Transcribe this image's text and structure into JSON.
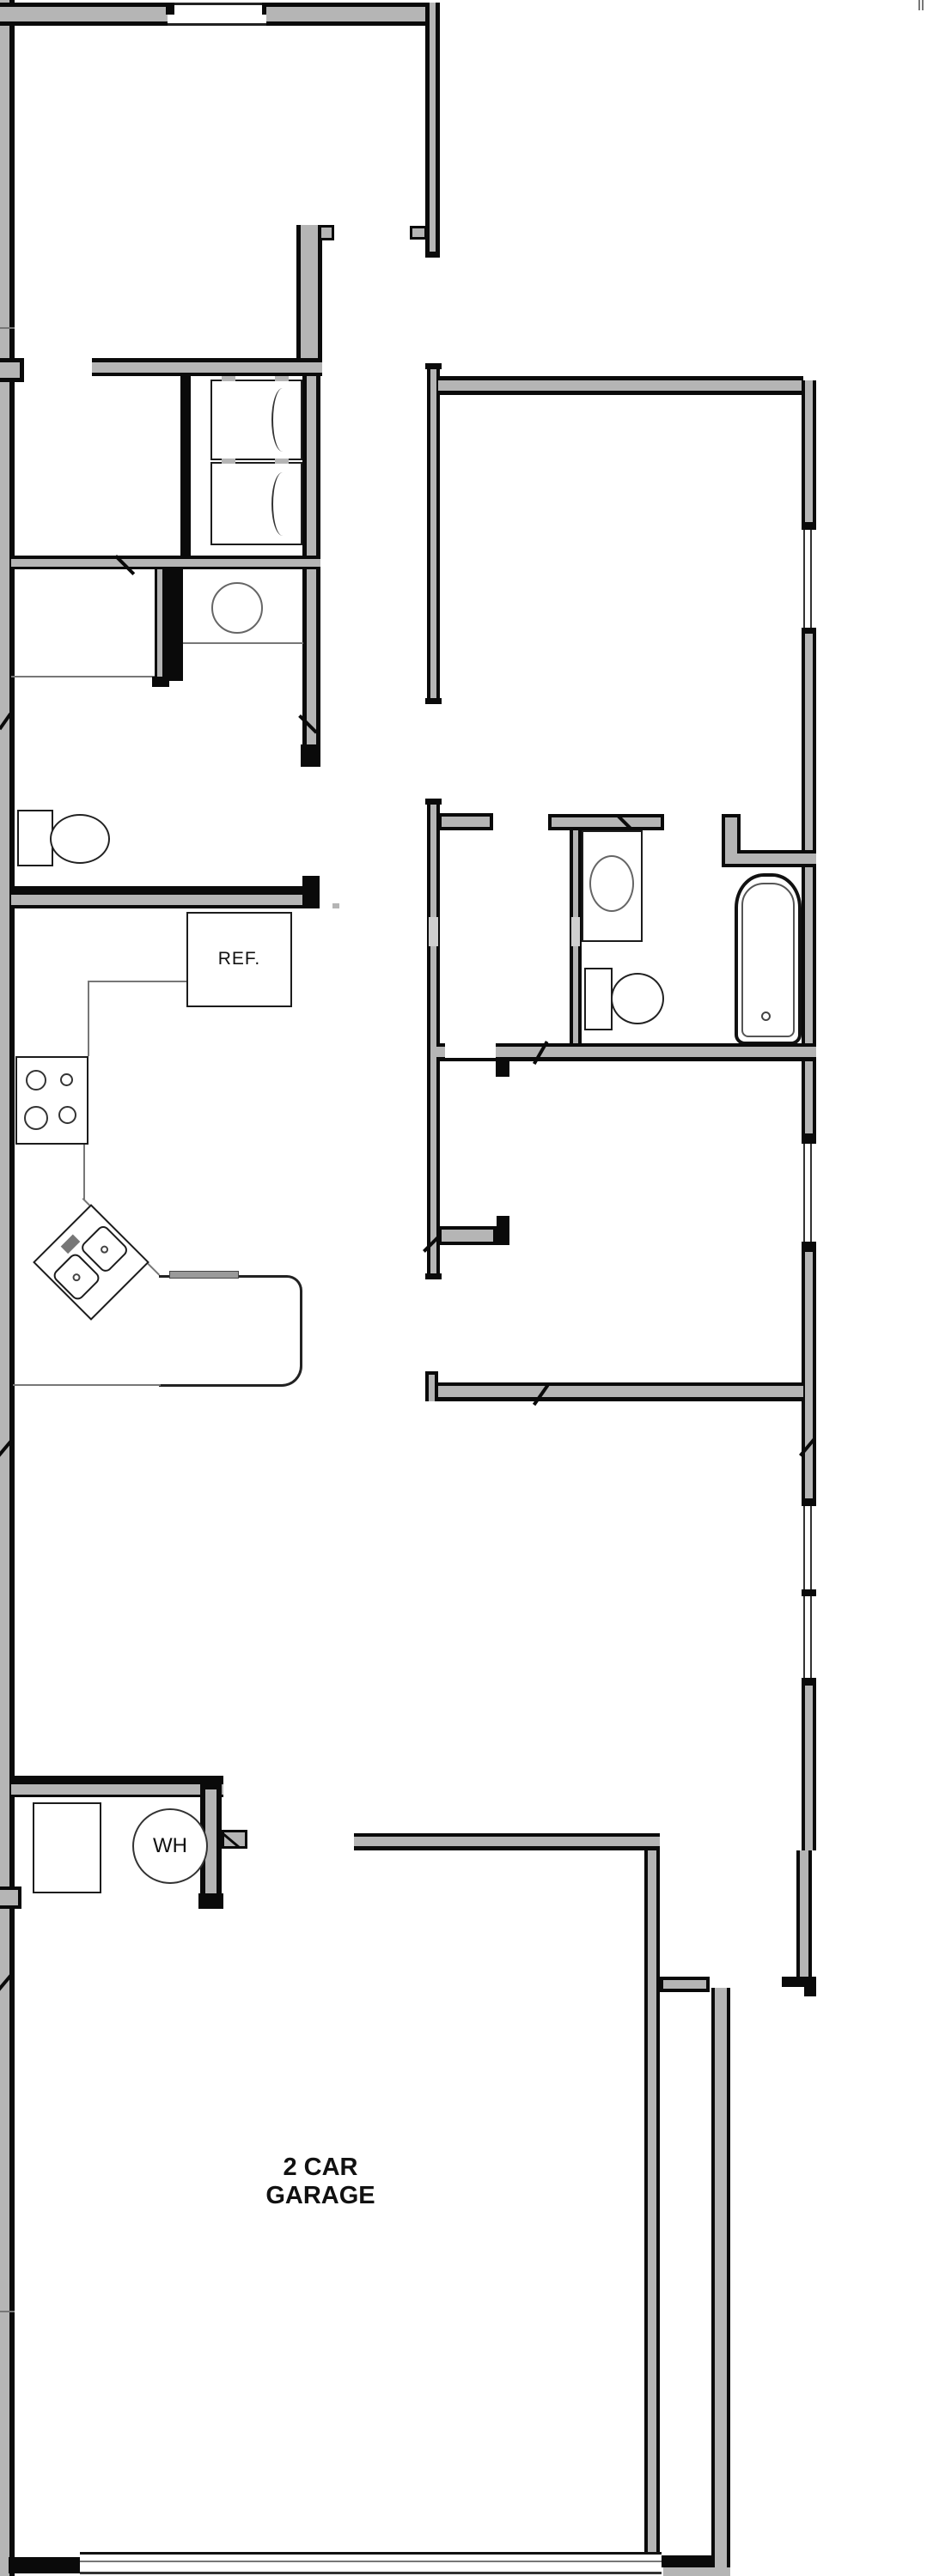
{
  "plan": {
    "title": "single-story house floor plan",
    "labels": {
      "refrigerator": "REF.",
      "water_heater": "WH",
      "garage": "2 CAR GARAGE"
    },
    "colors": {
      "background": "#ffffff",
      "wall_fill": "#b5b5b5",
      "wall_outline": "#0a0a0a",
      "fixture_line": "#444444",
      "thin_line": "#777777"
    },
    "fixtures": [
      "window",
      "door-opening",
      "door-swing",
      "washer",
      "dryer",
      "bathroom-sink",
      "toilet",
      "refrigerator",
      "range-stove",
      "corner-kitchen-sink",
      "dishwasher",
      "vanity-sink",
      "bathtub",
      "washing-machine",
      "water-heater",
      "garage-door"
    ]
  }
}
